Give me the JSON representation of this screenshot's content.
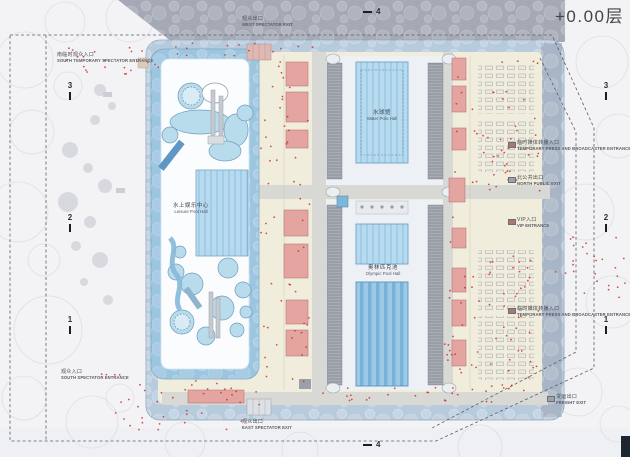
{
  "title": "+0.00层",
  "halls": {
    "leisure": {
      "zh": "水上娱乐中心",
      "en": "Leisure Pool Hall"
    },
    "water_polo": {
      "zh": "水球馆",
      "en": "Water Polo Hall"
    },
    "olympic": {
      "zh": "奥林匹克池",
      "en": "Olympic Pool Hall"
    }
  },
  "entrances": [
    {
      "zh": "南临时观众入口",
      "en": "SOUTH TEMPORARY SPECTATOR ENTRANCE"
    },
    {
      "zh": "观众出口",
      "en": "WEST SPECTATOR EXIT"
    },
    {
      "zh": "观众入口",
      "en": "SOUTH SPECTATOR ENTRANCE"
    },
    {
      "zh": "观众出口",
      "en": "EAST SPECTATOR EXIT"
    },
    {
      "zh": "临时媒体转播入口",
      "en": "TEMPORARY PRESS AND BROADCASTER ENTRANCE"
    },
    {
      "zh": "北公共出口",
      "en": "NORTH PUBLIC EXIT"
    },
    {
      "zh": "VIP入口",
      "en": "VIP ENTRANCE"
    },
    {
      "zh": "临时媒体转播入口",
      "en": "TEMPORARY PRESS AND BROADCASTER ENTRANCE"
    },
    {
      "zh": "货运出口",
      "en": "FREIGHT EXIT"
    }
  ],
  "grid": {
    "left": [
      "3",
      "2",
      "1"
    ],
    "right": [
      "3",
      "2",
      "1"
    ],
    "top": "4",
    "bottom": "4"
  },
  "colors": {
    "pool_water": "#b7daee",
    "olympic_pool": "#9ccae6",
    "room_pink": "#e4a5a0",
    "floor_yellow": "#f0eddc",
    "facade_blue": "#b7cbdd",
    "bleacher_grey": "#a8adb5",
    "crowd_dot_red": "#c8322b",
    "site_line": "#5d5d66"
  }
}
